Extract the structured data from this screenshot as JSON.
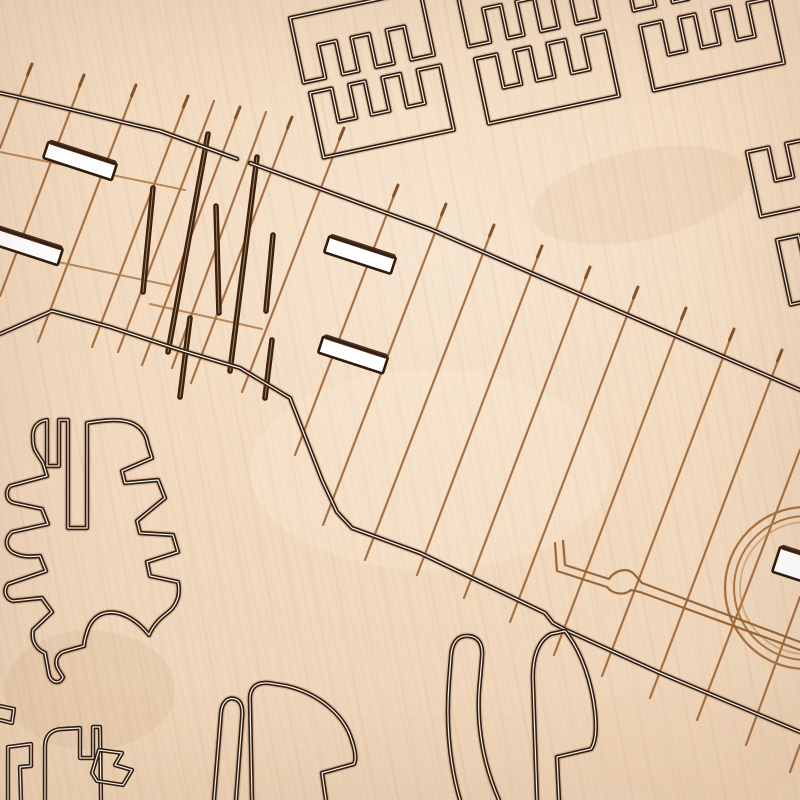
{
  "scene": {
    "type": "photograph",
    "subject": "Close-up of a laser-cut and laser-engraved light plywood sheet from a wooden map / model kit",
    "material": "birch plywood",
    "visible_text": "",
    "no_text_visible": true
  },
  "palette": {
    "wood_base": "#f2dabf",
    "wood_highlight": "#f7e5d0",
    "wood_shadow": "#ecd1b4",
    "engraving_light_brown": "#a06738",
    "engraving_road_brown": "#96602f",
    "deep_cut_brown": "#3f2008",
    "cut_edge_dark": "#331c0c",
    "kerf_highlight": "#ffffff",
    "cutout_backing": "#ffffff"
  },
  "elements": {
    "city_blocks": {
      "description": "comb-toothed rectangular block outlines cut into the top band, rotated about -12 degrees",
      "count_visible": 8
    },
    "shoreline_cuts": {
      "description": "two long diagonal through-cut polylines with bright kerf centres",
      "count": 2
    },
    "pier_hatch_lines": {
      "description": "thin parallel engraved lines crossing the diagonal cuts like piers",
      "count_visible": 21
    },
    "deep_street_cuts": {
      "description": "cluster of short thick dark engraved strokes, centre-left",
      "count": 7
    },
    "through_slots": {
      "description": "white rectangular slots cut fully through the sheet",
      "count": 5
    },
    "engraved_road": {
      "description": "double-line engraved road with a lens-shaped bridge symbol",
      "count": 1
    },
    "engraved_rings": {
      "description": "concentric circle engraving clipped by the right edge",
      "count": 1
    },
    "organic_parts": {
      "description": "rounded, notched cut-out parts along the bottom and lower left",
      "count": 8
    }
  }
}
